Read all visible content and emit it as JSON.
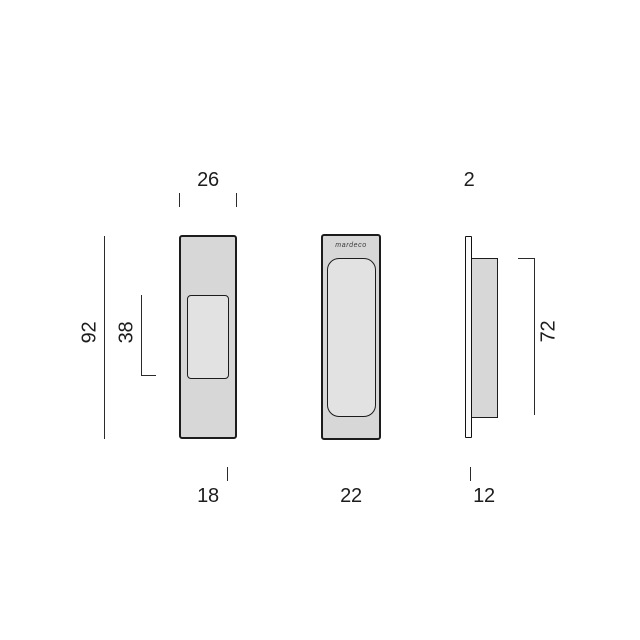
{
  "drawing": {
    "type": "technical-dimension-drawing",
    "brand_label": "mardeco",
    "views": {
      "front": {
        "dim_width_top": "26",
        "dim_height_overall": "92",
        "dim_pocket_height": "38",
        "dim_bottom": "18"
      },
      "face": {
        "dim_bottom": "22"
      },
      "side": {
        "dim_faceplate_thickness": "2",
        "dim_body_height": "72",
        "dim_bottom": "12"
      }
    },
    "colors": {
      "background": "#ffffff",
      "plate_fill": "#d7d7d7",
      "recess_fill": "#e2e2e2",
      "outline": "#1c1c1c",
      "dimension_line": "#2b2b2b",
      "text": "#1d1d1d"
    }
  }
}
